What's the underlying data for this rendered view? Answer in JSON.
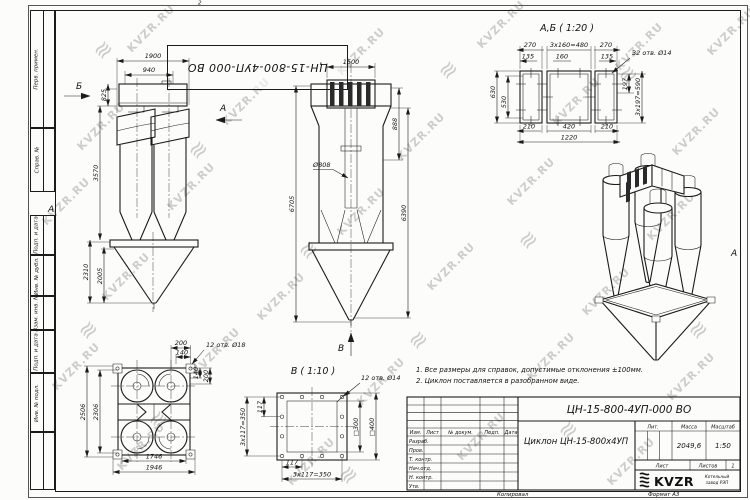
{
  "stamp_top": "ЦН-15-800-4УП-000 ВО",
  "watermark": {
    "text": "KVZR.RU",
    "logo_glyph": "≋"
  },
  "zone": {
    "top": "2",
    "left": "А",
    "right": "А"
  },
  "margin_fields": [
    "Перв. примен.",
    "Справ. №",
    "Подп. и дата",
    "Инв. № дубл.",
    "Взам. инв. №",
    "Подп. и дата",
    "Инв. № подл."
  ],
  "views": {
    "front": {
      "label_b": "Б",
      "label_a": "А",
      "d1900": "1900",
      "d940": "940",
      "d825": "825",
      "d3570": "3570",
      "d2310": "2310",
      "d2005": "2005"
    },
    "side": {
      "d1500": "1500",
      "d888": "888",
      "d808": "Ø808",
      "d6705": "6705",
      "d6390": "6390",
      "label_v": "В"
    },
    "section_ab": {
      "title": "А,Б ( 1:20 )",
      "holes": "32 отв. Ø14",
      "d270a": "270",
      "d480": "3x160=480",
      "d270b": "270",
      "d135a": "135",
      "d160": "160",
      "d135b": "135",
      "d630": "630",
      "d530": "530",
      "d210a": "210",
      "d420": "420",
      "d210b": "210",
      "d1220": "1220",
      "d197": "197",
      "d590": "3x197=590"
    },
    "plan": {
      "holes": "12 отв. Ø18",
      "d200t": "200",
      "d140t": "140",
      "d140r": "140",
      "d200r": "200",
      "d2506": "2506",
      "d2306": "2306",
      "d1746": "1746",
      "d1946": "1946"
    },
    "flange_v": {
      "title": "В ( 1:10 )",
      "holes": "12 отв. Ø14",
      "d117l": "117",
      "d350l": "3x117=350",
      "d300": "□300",
      "d400": "□400",
      "d117b": "117",
      "d350b": "3x117=350"
    }
  },
  "notes": {
    "line1": "1. Все размеры для справок, допустимые отклонения ±100мм.",
    "line2": "2. Циклон поставляется в разобранном виде."
  },
  "title_block": {
    "designation": "ЦН-15-800-4УП-000 ВО",
    "doc_name": "Циклон ЦН-15-800х4УП",
    "col_izm": "Изм.",
    "col_list": "Лист",
    "col_doc": "№ докум.",
    "col_sign": "Подп.",
    "col_date": "Дата",
    "row_razrab": "Разраб.",
    "row_prov": "Пров.",
    "row_tkontr": "Т. контр.",
    "row_nachotd": "Нач.отд.",
    "row_nkontr": "Н. контр.",
    "row_utv": "Утв.",
    "lit": "Лит.",
    "mass_label": "Масса",
    "scale_label": "Масштаб",
    "mass": "2049,6",
    "scale": "1:50",
    "sheet_label": "Лист",
    "sheets_label": "Листов",
    "sheets_value": "1",
    "brand": "KVZR",
    "brand_note1": "Котельный",
    "brand_note2": "завод РЭП",
    "copied": "Копировал",
    "format": "Формат А3"
  }
}
